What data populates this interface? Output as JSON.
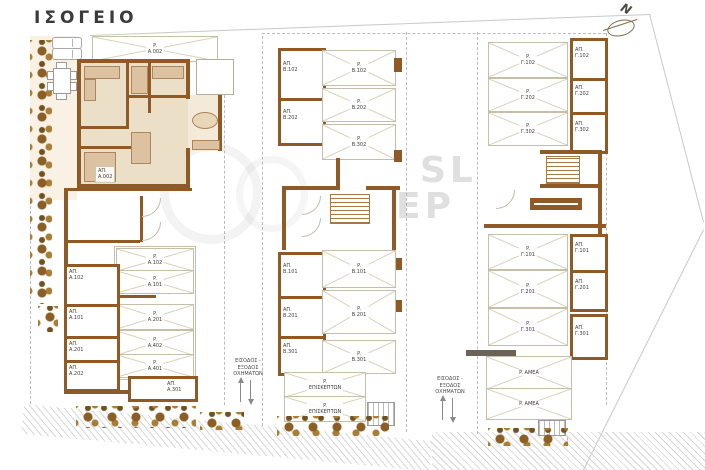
{
  "title": "ΙΣΟΓΕΙΟ",
  "north": {
    "label": "N"
  },
  "watermark": {
    "line1": "SL",
    "line2": "ΕΡ"
  },
  "entrances": {
    "left": "ΕΙΣΟΔΟΣ -\nΕΞΟΔΟΣ\nΟΧΗΜΑΤΩΝ",
    "right": "ΕΙΣΟΔΟΣ -\nΕΞΟΔΟΣ\nΟΧΗΜΑΤΩΝ"
  },
  "wing_a": {
    "yard_space": "P.\nA.002",
    "unit_label": "ΑΠ.\nA.002",
    "storages": [
      "ΑΠ.\nA.102",
      "ΑΠ.\nA.101",
      "ΑΠ.\nA.201",
      "ΑΠ.\nA.202"
    ],
    "parking": [
      "P.\nA.102",
      "P.\nA.101",
      "P.\nA.201",
      "P.\nA.402",
      "P.\nA.401"
    ],
    "bottom_storage": "ΑΠ.\nA.301"
  },
  "wing_b": {
    "storages_top": [
      "ΑΠ.\nΒ.102",
      "ΑΠ.\nΒ.202"
    ],
    "parking_top": [
      "P.\nΒ.102",
      "P.\nΒ.202",
      "P.\nΒ.302"
    ],
    "storages_bottom": [
      "ΑΠ.\nΒ.101",
      "ΑΠ.\nΒ.201",
      "ΑΠ.\nΒ.301"
    ],
    "parking_bottom": [
      "P.\nΒ.101",
      "P.\nΒ.201",
      "P.\nΒ.301"
    ],
    "visitors": [
      "P.\nΕΠΙΣΚΕΠΤΩΝ",
      "P.\nΕΠΙΣΚΕΠΤΩΝ"
    ]
  },
  "wing_c": {
    "parking_top": [
      "P.\nΓ.102",
      "P.\nΓ.202",
      "P.\nΓ.302"
    ],
    "storages_top": [
      "ΑΠ.\nΓ.102",
      "ΑΠ.\nΓ.202",
      "ΑΠ.\nΓ.302"
    ],
    "parking_bottom": [
      "P.\nΓ.101",
      "P.\nΓ.201",
      "P.\nΓ.301"
    ],
    "storages_bottom": [
      "ΑΠ.\nΓ.101",
      "ΑΠ.\nΓ.201",
      "ΑΠ.\nΓ.301"
    ],
    "accessible": [
      "P.  ΑΜΕΑ",
      "P.  ΑΜΕΑ"
    ]
  },
  "colors": {
    "wall_brown": "#8f5a26",
    "floor_beige": "#ecdfc8",
    "yard_beige": "#f8f1e4",
    "marking_gray": "#c6bfa8",
    "tree_brown": "#8a5e24",
    "text_gray": "#3f3f3f"
  }
}
